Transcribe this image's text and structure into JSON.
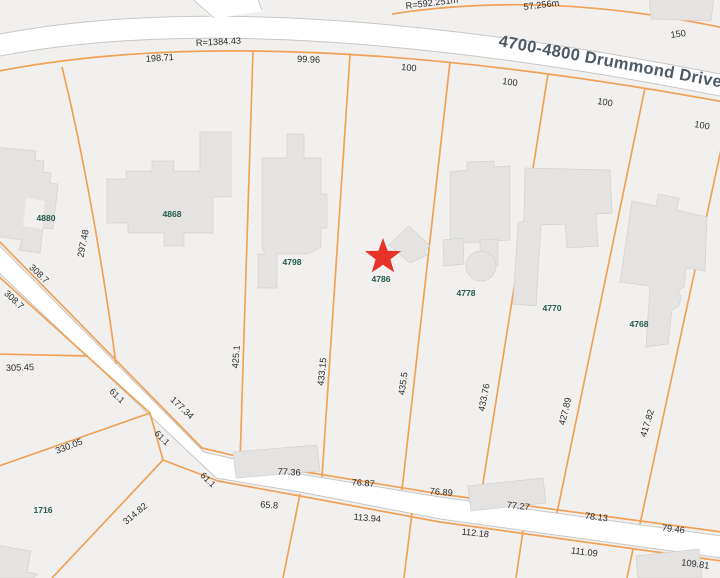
{
  "street": {
    "name": "4700-4800 Drummond Drive"
  },
  "annotations": {
    "radius_main": "R=1384.43",
    "radius_upper": "R=592.251m",
    "arc_upper": "57.256m",
    "frontage_north": "150"
  },
  "parcels": {
    "p4880": "4880",
    "p4868": "4868",
    "p4798": "4798",
    "p4786": "4786",
    "p4778": "4778",
    "p4770": "4770",
    "p4768": "4768",
    "p1716": "1716"
  },
  "top_frontages": [
    "198.71",
    "99.96",
    "100",
    "100",
    "100",
    "100"
  ],
  "lot_depths": [
    "297.48",
    "425.1",
    "433.15",
    "435.5",
    "433.76",
    "427.89",
    "417.82"
  ],
  "west_dims": {
    "d308a": "308.7",
    "d308b": "308.7",
    "d305": "305.45",
    "d330": "330.05",
    "d61a": "61.1",
    "d177": "177.34",
    "d61b": "61.1",
    "d61c": "61.1",
    "d314": "314.82"
  },
  "south_frontages_north_side": [
    "77.36",
    "76.87",
    "76.89",
    "77.27",
    "78.13",
    "79.46"
  ],
  "south_frontages_south_side": [
    "65.8",
    "113.94",
    "112.18",
    "111.09",
    "109.81"
  ],
  "colors": {
    "lot_line": "#f0a158",
    "road_casing": "#c8c7c5",
    "building": "#e4e3e1",
    "parcel_label": "#235d4c",
    "dimension_label": "#2d2d2d",
    "street_label": "#4d5a64",
    "marker": "#e8332a",
    "background": "#f1f0ee"
  }
}
